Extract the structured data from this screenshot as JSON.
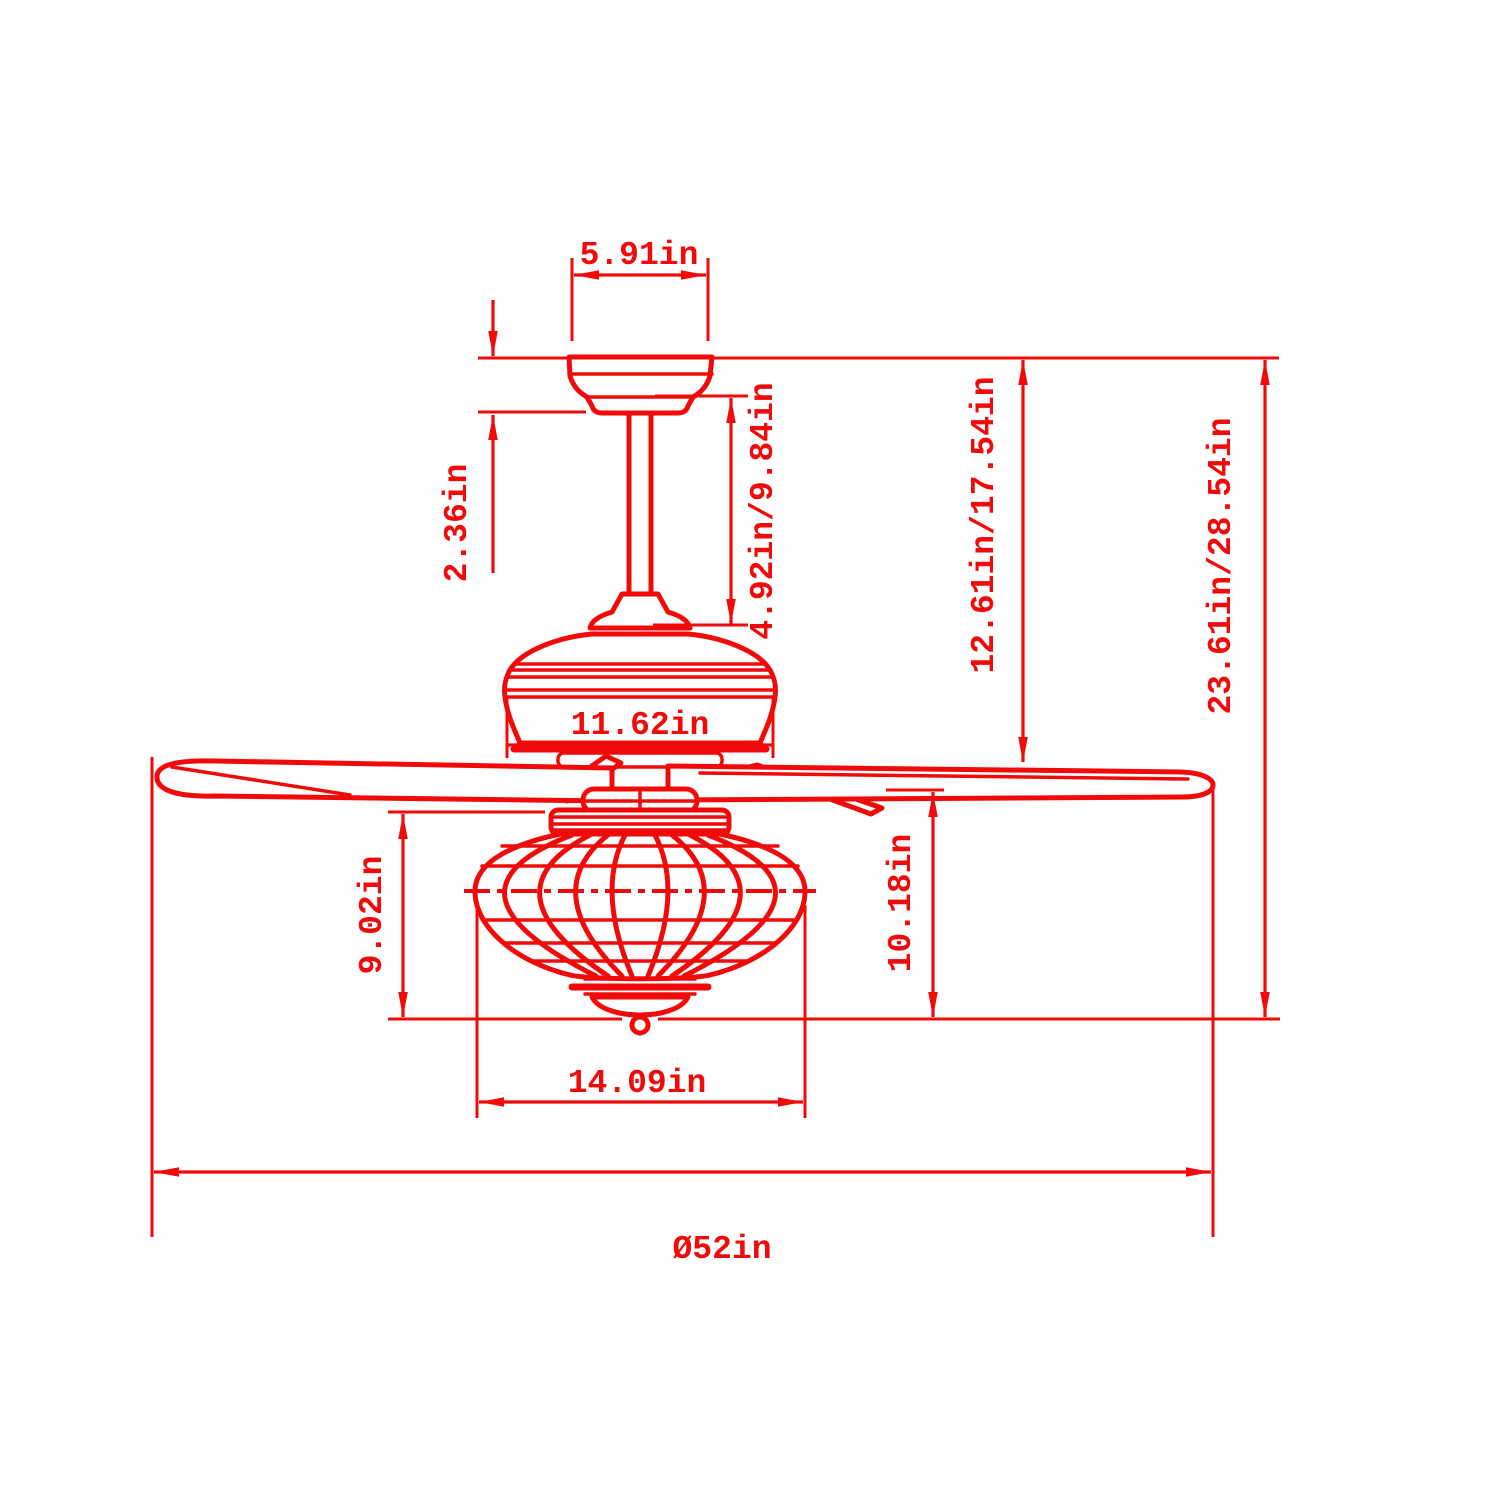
{
  "drawing": {
    "type": "ceiling-fan-dimension-diagram",
    "stroke_color": "#F00A0A",
    "background_color": "#FFFFFF"
  },
  "dimensions": {
    "canopy_width": "5.91in",
    "canopy_height": "2.36in",
    "downrod_length": "4.92in/9.84in",
    "motor_housing_width": "11.62in",
    "ceiling_to_blades": "12.61in/17.54in",
    "total_height": "23.61in/28.54in",
    "light_kit_height": "9.02in",
    "blades_to_bottom": "10.18in",
    "light_kit_width": "14.09in",
    "blade_sweep_diameter": "Ø52in"
  }
}
